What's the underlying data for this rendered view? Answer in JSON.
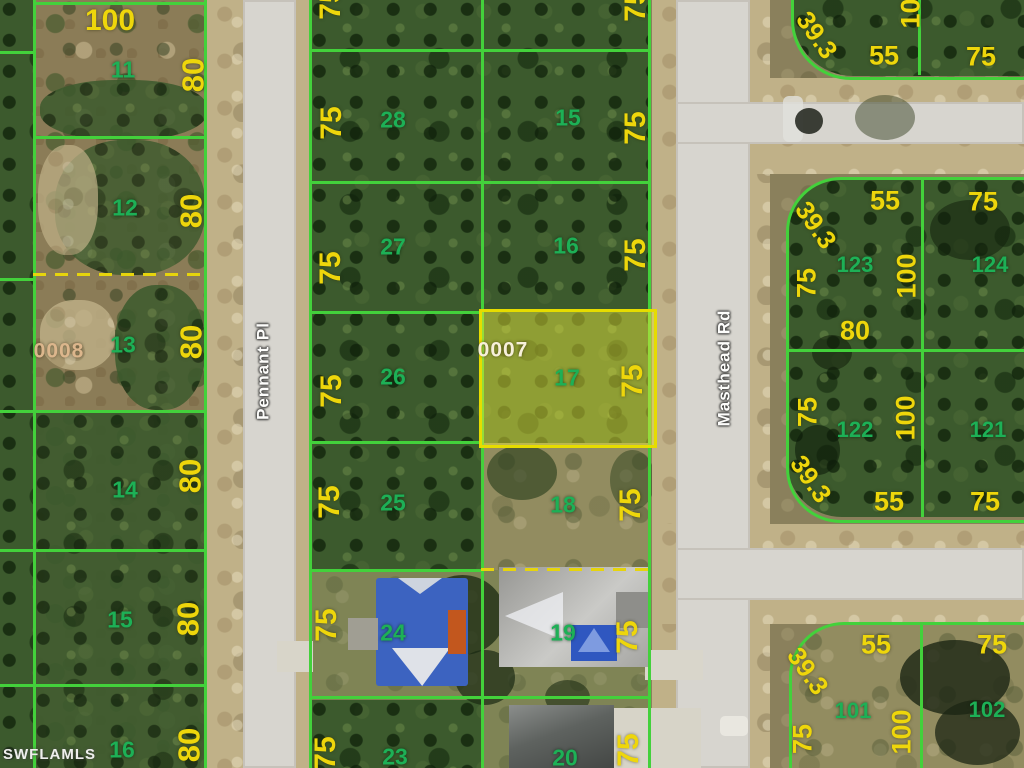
{
  "watermark": "SWFLAMLS",
  "highlight": {
    "parcel_id": "0007",
    "lot_number": "17"
  },
  "reference_parcel_id": "0008",
  "streets": [
    {
      "name": "Pennant Pl",
      "x": 263,
      "y": 371
    },
    {
      "name": "Masthead Rd",
      "x": 724,
      "y": 368
    }
  ],
  "parcel_ids": [
    {
      "text": "0008",
      "x": 59,
      "y": 351,
      "color": "#dcb68c"
    },
    {
      "text": "0007",
      "x": 503,
      "y": 350,
      "color": "#f7f0da"
    }
  ],
  "lot_numbers": [
    {
      "text": "11",
      "x": 123,
      "y": 70
    },
    {
      "text": "12",
      "x": 125,
      "y": 208
    },
    {
      "text": "13",
      "x": 123,
      "y": 345
    },
    {
      "text": "14",
      "x": 125,
      "y": 490
    },
    {
      "text": "15",
      "x": 120,
      "y": 620
    },
    {
      "text": "16",
      "x": 122,
      "y": 750
    },
    {
      "text": "28",
      "x": 393,
      "y": 120
    },
    {
      "text": "27",
      "x": 393,
      "y": 247
    },
    {
      "text": "26",
      "x": 393,
      "y": 377
    },
    {
      "text": "25",
      "x": 393,
      "y": 503
    },
    {
      "text": "24",
      "x": 393,
      "y": 633
    },
    {
      "text": "23",
      "x": 395,
      "y": 757
    },
    {
      "text": "15",
      "x": 568,
      "y": 118
    },
    {
      "text": "16",
      "x": 566,
      "y": 246
    },
    {
      "text": "17",
      "x": 567,
      "y": 378
    },
    {
      "text": "18",
      "x": 563,
      "y": 505
    },
    {
      "text": "19",
      "x": 563,
      "y": 633
    },
    {
      "text": "20",
      "x": 565,
      "y": 758
    },
    {
      "text": "123",
      "x": 855,
      "y": 265,
      "fs": 22
    },
    {
      "text": "124",
      "x": 990,
      "y": 265,
      "fs": 22
    },
    {
      "text": "122",
      "x": 855,
      "y": 430,
      "fs": 22
    },
    {
      "text": "121",
      "x": 988,
      "y": 430,
      "fs": 22
    },
    {
      "text": "101",
      "x": 853,
      "y": 711,
      "fs": 22
    },
    {
      "text": "102",
      "x": 987,
      "y": 710,
      "fs": 22
    }
  ],
  "dimensions": [
    {
      "text": "100",
      "x": 110,
      "y": 21
    },
    {
      "text": "80",
      "x": 193,
      "y": 75,
      "rot": -90,
      "fs": 31
    },
    {
      "text": "80",
      "x": 191,
      "y": 211,
      "rot": -90,
      "fs": 31
    },
    {
      "text": "80",
      "x": 191,
      "y": 342,
      "rot": -90,
      "fs": 31
    },
    {
      "text": "80",
      "x": 190,
      "y": 476,
      "rot": -90,
      "fs": 31
    },
    {
      "text": "80",
      "x": 188,
      "y": 619,
      "rot": -90,
      "fs": 31
    },
    {
      "text": "80",
      "x": 189,
      "y": 745,
      "rot": -90,
      "fs": 31
    },
    {
      "text": "75",
      "x": 331,
      "y": 3,
      "rot": -90
    },
    {
      "text": "75",
      "x": 636,
      "y": 5,
      "rot": -90
    },
    {
      "text": "75",
      "x": 332,
      "y": 123,
      "rot": -90
    },
    {
      "text": "75",
      "x": 636,
      "y": 128,
      "rot": -90
    },
    {
      "text": "75",
      "x": 331,
      "y": 268,
      "rot": -90
    },
    {
      "text": "75",
      "x": 636,
      "y": 255,
      "rot": -90
    },
    {
      "text": "75",
      "x": 332,
      "y": 391,
      "rot": -90
    },
    {
      "text": "75",
      "x": 633,
      "y": 381,
      "rot": -90
    },
    {
      "text": "75",
      "x": 330,
      "y": 502,
      "rot": -90
    },
    {
      "text": "75",
      "x": 631,
      "y": 505,
      "rot": -90
    },
    {
      "text": "75",
      "x": 327,
      "y": 625,
      "rot": -90
    },
    {
      "text": "75",
      "x": 628,
      "y": 637,
      "rot": -90
    },
    {
      "text": "75",
      "x": 326,
      "y": 753,
      "rot": -90
    },
    {
      "text": "75",
      "x": 629,
      "y": 750,
      "rot": -90
    },
    {
      "text": "39.3",
      "x": 817,
      "y": 35,
      "rot": 55,
      "fs": 26
    },
    {
      "text": "100",
      "x": 911,
      "y": 6,
      "rot": -90,
      "fs": 27
    },
    {
      "text": "55",
      "x": 884,
      "y": 56,
      "fs": 27
    },
    {
      "text": "75",
      "x": 981,
      "y": 57,
      "fs": 27
    },
    {
      "text": "55",
      "x": 885,
      "y": 201,
      "fs": 27
    },
    {
      "text": "75",
      "x": 983,
      "y": 202,
      "fs": 27
    },
    {
      "text": "39.3",
      "x": 816,
      "y": 225,
      "rot": 55,
      "fs": 26
    },
    {
      "text": "75",
      "x": 807,
      "y": 283,
      "rot": -90,
      "fs": 27
    },
    {
      "text": "100",
      "x": 907,
      "y": 276,
      "rot": -90,
      "fs": 27
    },
    {
      "text": "80",
      "x": 855,
      "y": 331,
      "fs": 27
    },
    {
      "text": "75",
      "x": 808,
      "y": 412,
      "rot": -90,
      "fs": 27
    },
    {
      "text": "100",
      "x": 906,
      "y": 418,
      "rot": -90,
      "fs": 27
    },
    {
      "text": "39.3",
      "x": 811,
      "y": 479,
      "rot": 55,
      "fs": 26
    },
    {
      "text": "55",
      "x": 889,
      "y": 502,
      "fs": 27
    },
    {
      "text": "75",
      "x": 985,
      "y": 502,
      "fs": 27
    },
    {
      "text": "55",
      "x": 876,
      "y": 645,
      "fs": 27
    },
    {
      "text": "75",
      "x": 992,
      "y": 645,
      "fs": 27
    },
    {
      "text": "39.3",
      "x": 808,
      "y": 671,
      "rot": 55,
      "fs": 26
    },
    {
      "text": "100",
      "x": 902,
      "y": 732,
      "rot": -90,
      "fs": 27
    },
    {
      "text": "75",
      "x": 803,
      "y": 739,
      "rot": -90,
      "fs": 27
    }
  ],
  "colors": {
    "parcel_line": "#43d13b",
    "highlight_border": "#e6dc00",
    "highlight_fill": "rgba(235,233,60,0.48)",
    "dimension_text": "#eed60b",
    "lot_text": "#1db056",
    "street_text": "#fdfdfb"
  }
}
